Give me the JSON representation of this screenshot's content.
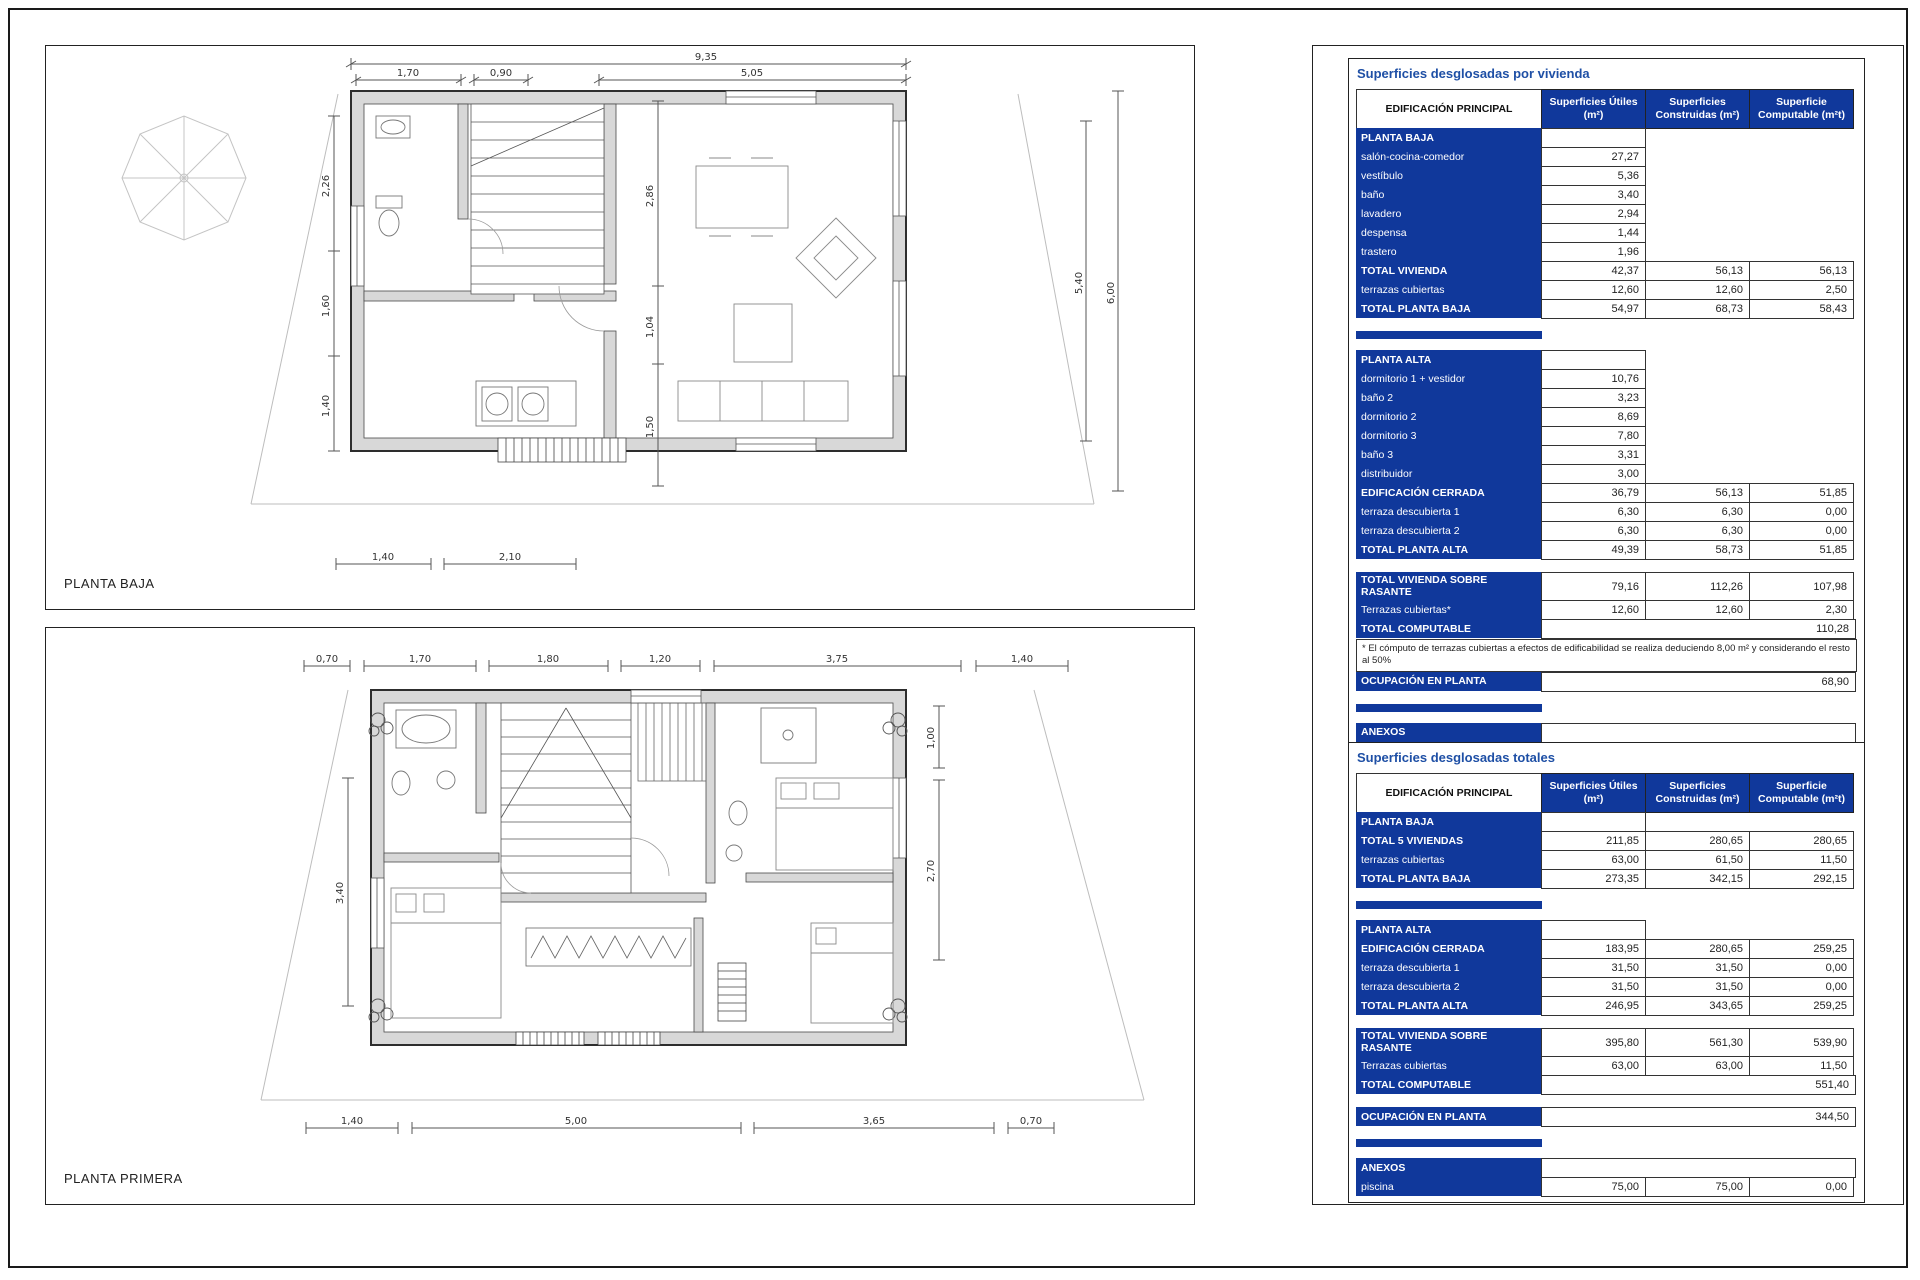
{
  "plans": {
    "baja": {
      "label": "PLANTA BAJA",
      "dims": {
        "overall_top": "9,35",
        "top": [
          "1,70",
          "0,90",
          "5,05"
        ],
        "left": [
          "2,26",
          "1,60",
          "1,40"
        ],
        "inner": [
          "2,86",
          "1,04",
          "1,50"
        ],
        "right_inner": "5,40",
        "right_outer": "6,00",
        "bottom": [
          "1,40",
          "2,10"
        ]
      }
    },
    "primera": {
      "label": "PLANTA PRIMERA",
      "dims": {
        "top": [
          "0,70",
          "1,70",
          "1,80",
          "1,20",
          "3,75",
          "1,40"
        ],
        "left": "3,40",
        "right": [
          "1,00",
          "2,70"
        ],
        "bottom": [
          "1,40",
          "5,00",
          "3,65",
          "0,70"
        ]
      }
    }
  },
  "panel": {
    "tables": [
      {
        "title": "Superficies desglosadas por vivienda",
        "header": {
          "label": "EDIFICACIÓN PRINCIPAL",
          "cols": [
            "Superficies Útiles\n(m²)",
            "Superficies\nConstruidas (m²)",
            "Superficie\nComputable (m²t)"
          ]
        },
        "rows": [
          {
            "t": "sec",
            "label": "PLANTA BAJA"
          },
          {
            "t": "item",
            "label": "salón-cocina-comedor",
            "v": [
              "27,27"
            ]
          },
          {
            "t": "item",
            "label": "vestíbulo",
            "v": [
              "5,36"
            ]
          },
          {
            "t": "item",
            "label": "baño",
            "v": [
              "3,40"
            ]
          },
          {
            "t": "item",
            "label": "lavadero",
            "v": [
              "2,94"
            ]
          },
          {
            "t": "item",
            "label": "despensa",
            "v": [
              "1,44"
            ]
          },
          {
            "t": "item",
            "label": "trastero",
            "v": [
              "1,96"
            ]
          },
          {
            "t": "total",
            "label": "TOTAL VIVIENDA",
            "v": [
              "42,37",
              "56,13",
              "56,13"
            ]
          },
          {
            "t": "item3",
            "label": "terrazas cubiertas",
            "v": [
              "12,60",
              "12,60",
              "2,50"
            ]
          },
          {
            "t": "total",
            "label": "TOTAL PLANTA BAJA",
            "v": [
              "54,97",
              "68,73",
              "58,43"
            ]
          },
          {
            "t": "gap"
          },
          {
            "t": "cap"
          },
          {
            "t": "sec",
            "label": "PLANTA ALTA"
          },
          {
            "t": "item",
            "label": "dormitorio 1 + vestidor",
            "v": [
              "10,76"
            ]
          },
          {
            "t": "item",
            "label": "baño 2",
            "v": [
              "3,23"
            ]
          },
          {
            "t": "item",
            "label": "dormitorio 2",
            "v": [
              "8,69"
            ]
          },
          {
            "t": "item",
            "label": "dormitorio 3",
            "v": [
              "7,80"
            ]
          },
          {
            "t": "item",
            "label": "baño 3",
            "v": [
              "3,31"
            ]
          },
          {
            "t": "item",
            "label": "distribuidor",
            "v": [
              "3,00"
            ]
          },
          {
            "t": "total",
            "label": "EDIFICACIÓN CERRADA",
            "v": [
              "36,79",
              "56,13",
              "51,85"
            ]
          },
          {
            "t": "item3",
            "label": "terraza descubierta 1",
            "v": [
              "6,30",
              "6,30",
              "0,00"
            ]
          },
          {
            "t": "item3",
            "label": "terraza descubierta 2",
            "v": [
              "6,30",
              "6,30",
              "0,00"
            ]
          },
          {
            "t": "total",
            "label": "TOTAL PLANTA ALTA",
            "v": [
              "49,39",
              "58,73",
              "51,85"
            ]
          },
          {
            "t": "gap"
          },
          {
            "t": "total",
            "label": "TOTAL VIVIENDA SOBRE RASANTE",
            "v": [
              "79,16",
              "112,26",
              "107,98"
            ]
          },
          {
            "t": "item3",
            "label": "Terrazas cubiertas*",
            "v": [
              "12,60",
              "12,60",
              "2,30"
            ]
          },
          {
            "t": "wide",
            "label": "TOTAL COMPUTABLE",
            "v": "110,28"
          },
          {
            "t": "note",
            "text": "* El cómputo de terrazas cubiertas a efectos de edificabilidad se realiza deduciendo 8,00 m² y considerando el resto al 50%"
          },
          {
            "t": "wide",
            "label": "OCUPACIÓN EN PLANTA",
            "v": "68,90"
          },
          {
            "t": "gap"
          },
          {
            "t": "cap"
          },
          {
            "t": "sec",
            "label": "ANEXOS",
            "c": 3
          },
          {
            "t": "item3",
            "label": "piscina",
            "v": [
              "15,00",
              "15,00",
              "0,00"
            ]
          }
        ]
      },
      {
        "title": "Superficies desglosadas totales",
        "header": {
          "label": "EDIFICACIÓN PRINCIPAL",
          "cols": [
            "Superficies Útiles\n(m²)",
            "Superficies\nConstruidas (m²)",
            "Superficie\nComputable (m²t)"
          ]
        },
        "rows": [
          {
            "t": "sec",
            "label": "PLANTA BAJA"
          },
          {
            "t": "total",
            "label": "TOTAL 5 VIVIENDAS",
            "v": [
              "211,85",
              "280,65",
              "280,65"
            ]
          },
          {
            "t": "item3",
            "label": "terrazas cubiertas",
            "v": [
              "63,00",
              "61,50",
              "11,50"
            ]
          },
          {
            "t": "total",
            "label": "TOTAL PLANTA BAJA",
            "v": [
              "273,35",
              "342,15",
              "292,15"
            ]
          },
          {
            "t": "gap"
          },
          {
            "t": "cap"
          },
          {
            "t": "sec",
            "label": "PLANTA ALTA"
          },
          {
            "t": "total",
            "label": "EDIFICACIÓN CERRADA",
            "v": [
              "183,95",
              "280,65",
              "259,25"
            ]
          },
          {
            "t": "item3",
            "label": "terraza descubierta 1",
            "v": [
              "31,50",
              "31,50",
              "0,00"
            ]
          },
          {
            "t": "item3",
            "label": "terraza descubierta 2",
            "v": [
              "31,50",
              "31,50",
              "0,00"
            ]
          },
          {
            "t": "total",
            "label": "TOTAL PLANTA ALTA",
            "v": [
              "246,95",
              "343,65",
              "259,25"
            ]
          },
          {
            "t": "gap"
          },
          {
            "t": "total",
            "label": "TOTAL VIVIENDA SOBRE RASANTE",
            "v": [
              "395,80",
              "561,30",
              "539,90"
            ]
          },
          {
            "t": "item3",
            "label": "Terrazas cubiertas",
            "v": [
              "63,00",
              "63,00",
              "11,50"
            ]
          },
          {
            "t": "wide",
            "label": "TOTAL COMPUTABLE",
            "v": "551,40"
          },
          {
            "t": "gap"
          },
          {
            "t": "wide",
            "label": "OCUPACIÓN EN PLANTA",
            "v": "344,50"
          },
          {
            "t": "gap"
          },
          {
            "t": "cap"
          },
          {
            "t": "sec",
            "label": "ANEXOS",
            "c": 3
          },
          {
            "t": "item3",
            "label": "piscina",
            "v": [
              "75,00",
              "75,00",
              "0,00"
            ]
          }
        ]
      }
    ]
  }
}
